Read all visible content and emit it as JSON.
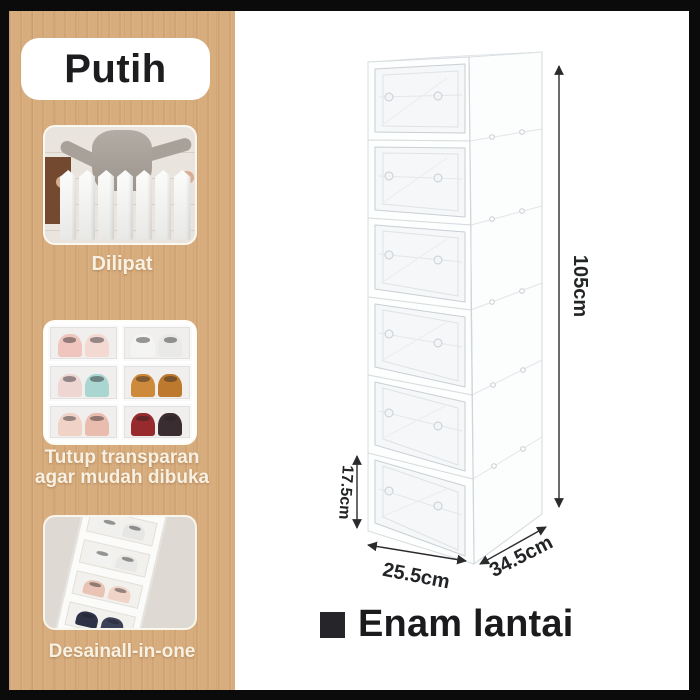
{
  "banner": {
    "background": "#0b0b0b",
    "left_panel": {
      "wood_color": "#d8ad7e",
      "caption_color": "#f8f1e2",
      "variant_badge": {
        "label": "Putih",
        "bg_color": "#ffffff",
        "text_color": "#1d1d1f"
      },
      "features": [
        {
          "caption": "Dilipat",
          "photo": "woman-holding-folded-organizer"
        },
        {
          "caption_line1": "Tutup transparan",
          "caption_line2": "agar mudah dibuka",
          "photo": "stacked-clear-shoe-boxes-with-shoes"
        },
        {
          "caption": "Desainall-in-one",
          "photo": "diagonal-row-of-shoe-compartments"
        }
      ]
    },
    "right_panel": {
      "background": "#ffffff",
      "cabinet": {
        "tier_count": 6,
        "body_color": "#fdfdfd",
        "dimensions": {
          "height_label": "105cm",
          "tier_height_label": "17.5cm",
          "width_label": "25.5cm",
          "depth_label": "34.5cm"
        }
      },
      "footer": {
        "label": "Enam lantai",
        "bullet_color": "#26262a",
        "text_color": "#1b1b1d"
      }
    }
  }
}
